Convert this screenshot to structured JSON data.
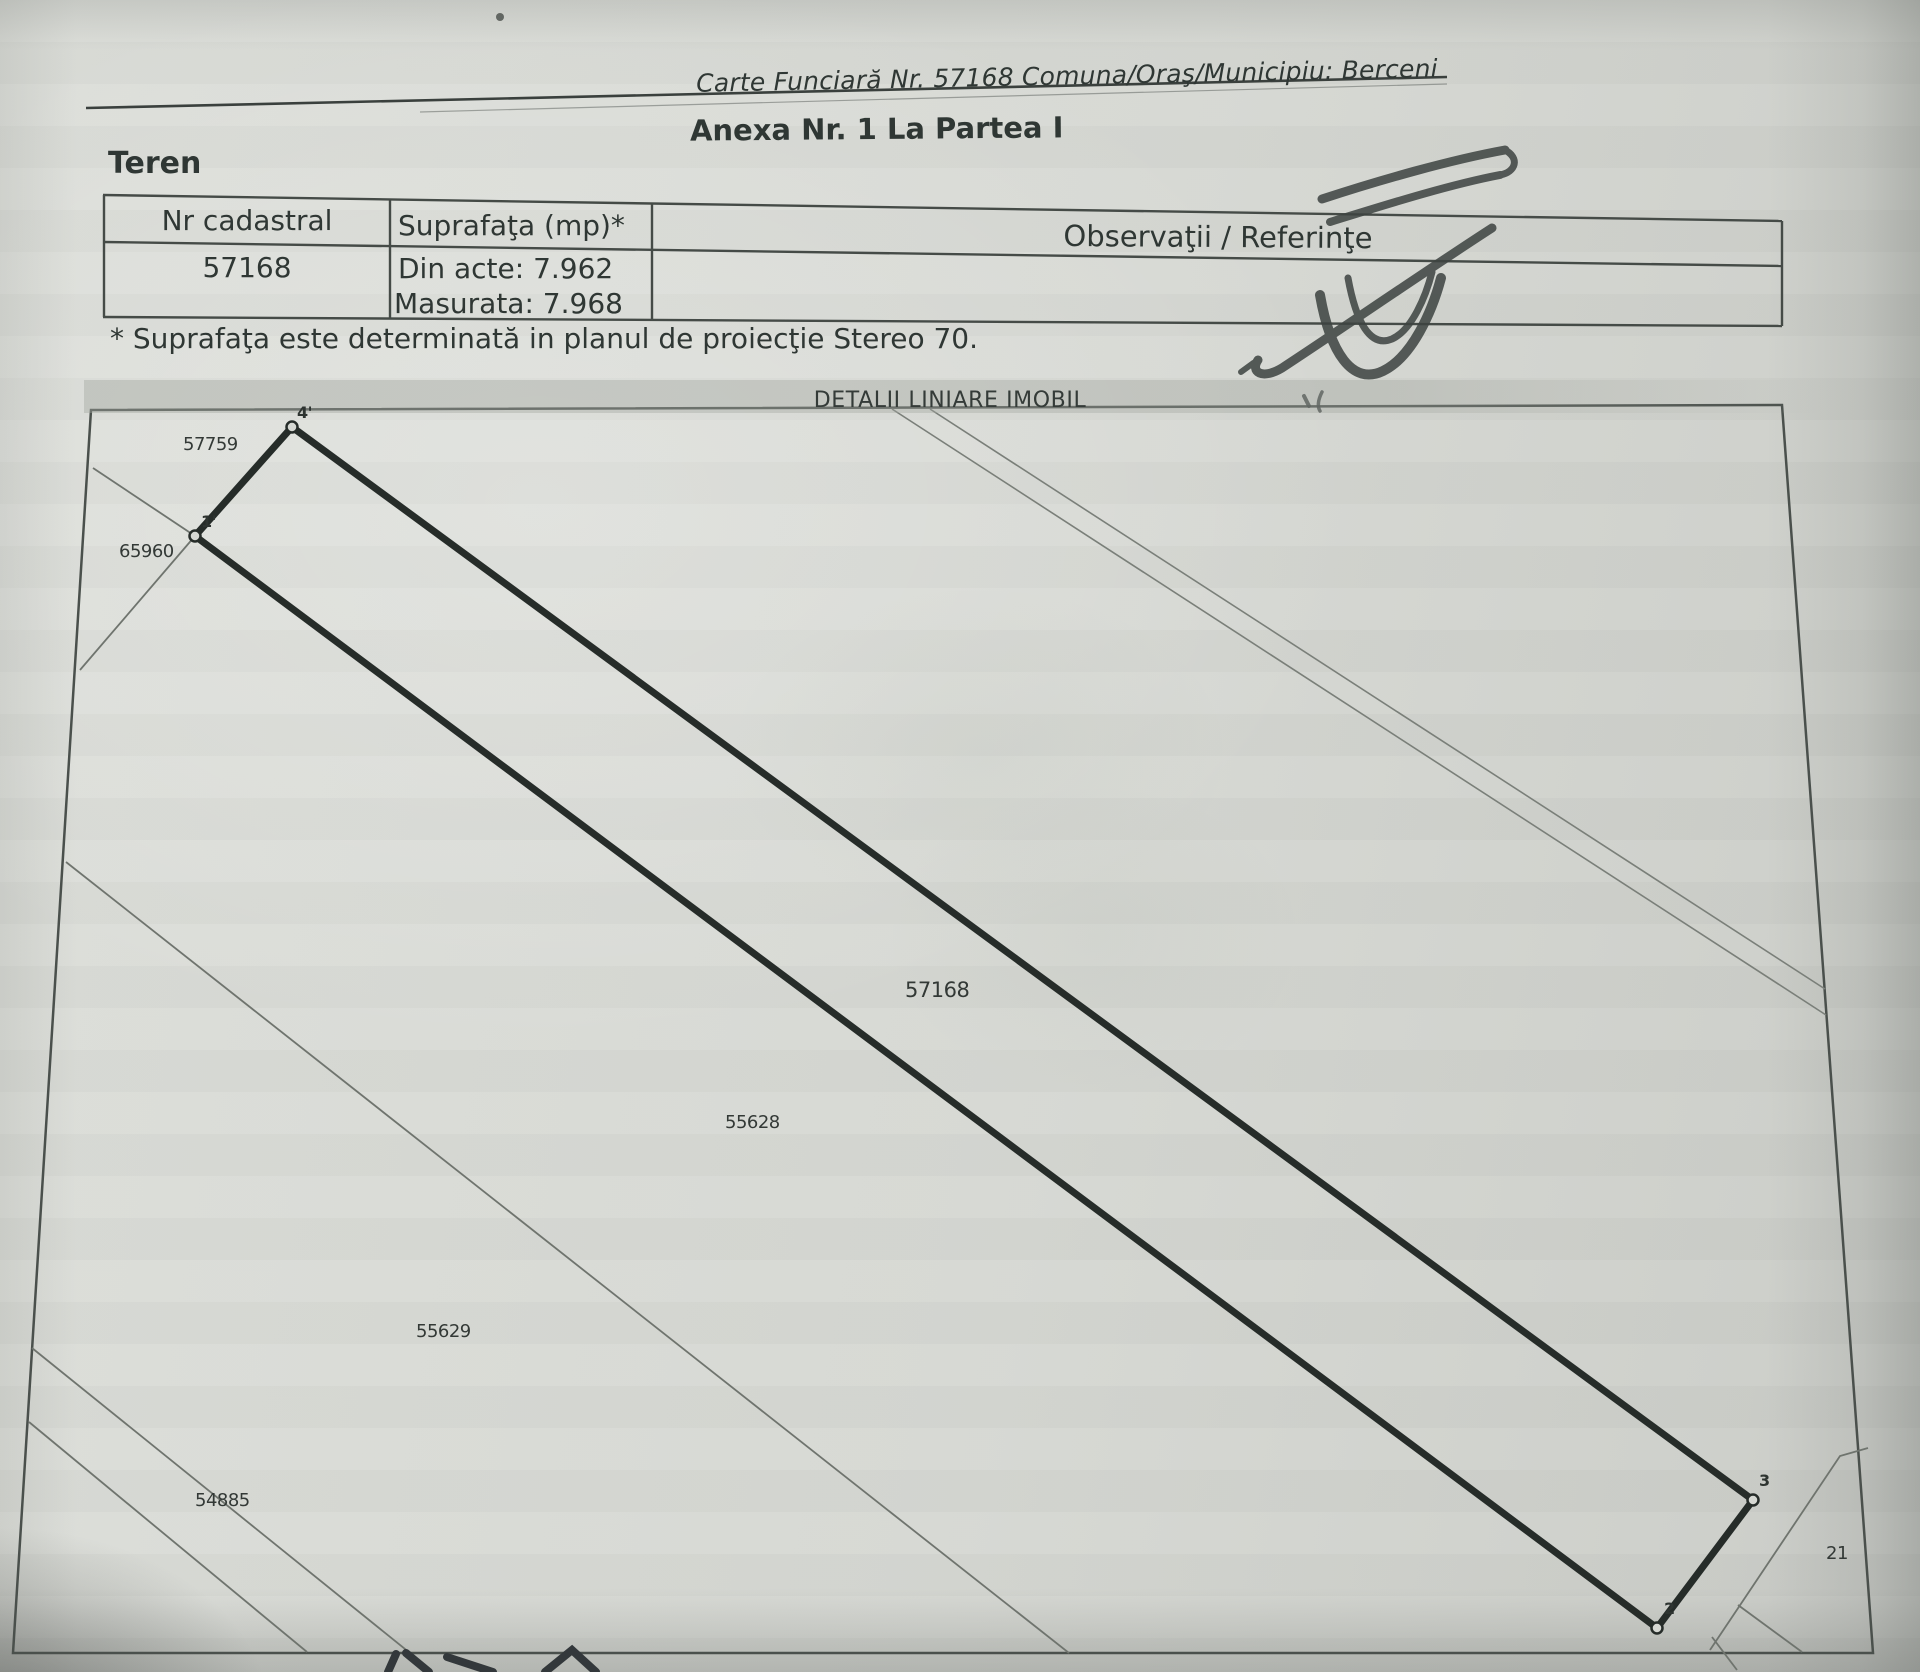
{
  "document": {
    "carte_funciara": "Carte Funciară Nr. 57168 Comuna/Oraş/Municipiu: Berceni",
    "anexa_title": "Anexa Nr. 1 La Partea I",
    "section_title": "Teren",
    "footnote": "* Suprafaţa este determinată in planul de proiecţie Stereo 70.",
    "plan_title": "DETALII LINIARE IMOBIL"
  },
  "table": {
    "headers": [
      "Nr cadastral",
      "Suprafaţa (mp)*",
      "Observaţii / Referinţe"
    ],
    "row": {
      "nr_cadastral": "57168",
      "suprafata_din_acte": "Din acte: 7.962",
      "suprafata_masurata": "Masurata: 7.968",
      "observatii": ""
    }
  },
  "plan": {
    "parcels": {
      "p57759": "57759",
      "p65960": "65960",
      "p57168": "57168",
      "p55628": "55628",
      "p55629": "55629",
      "p54885": "54885",
      "p21": "21"
    },
    "points": {
      "p4": "4'",
      "p1": "1'",
      "p3": "3",
      "p2": "2"
    }
  },
  "colors": {
    "ink": "#2f3734",
    "paper": "#d6d8d3",
    "thick_line": "#262c29",
    "thin_line": "#6f746e",
    "border": "#4a504c",
    "signature": "#3d4341"
  }
}
